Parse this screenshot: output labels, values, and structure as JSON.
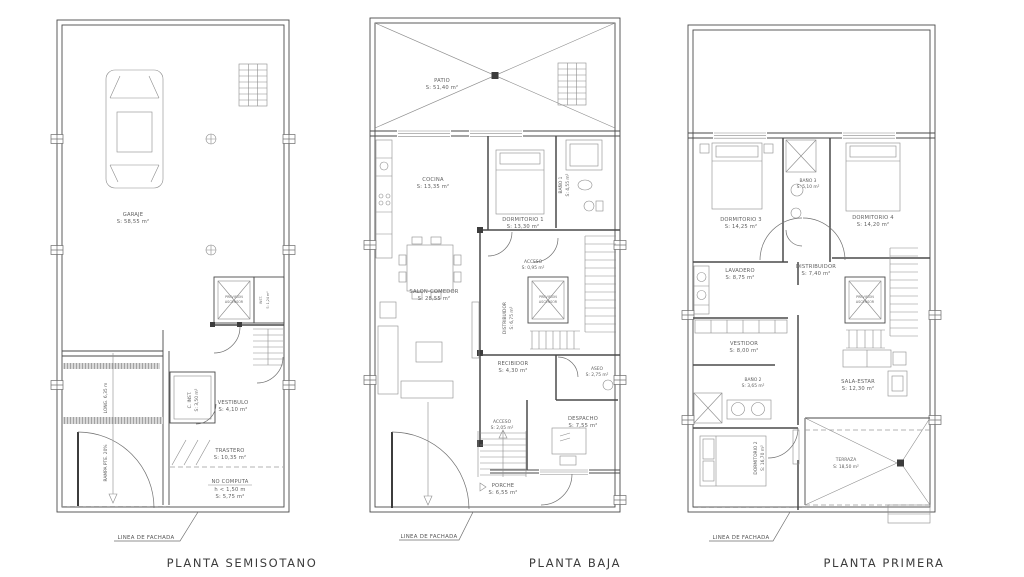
{
  "colors": {
    "background": "#ffffff",
    "line": "#4a4a4a",
    "text": "#5f5f5f",
    "title_text": "#3c3c3c"
  },
  "plans": [
    {
      "title": "PLANTA SEMISOTANO",
      "facade_label": "LINEA DE FACHADA",
      "rooms": {
        "garaje": {
          "name": "GARAJE",
          "area": "S: 58,55 m²"
        },
        "ascensor": {
          "line1": "PREVISION",
          "line2": "ASCENSOR"
        },
        "inst": {
          "name": "INST.",
          "area": "S: 1,24 m²"
        },
        "vestibulo": {
          "name": "VESTIBULO",
          "area": "S: 4,10 m²"
        },
        "c_inst": {
          "name": "C. INST.",
          "area": "S: 3,50 m²"
        },
        "trastero": {
          "name": "TRASTERO",
          "area": "S: 10,35 m²"
        },
        "no_computa": {
          "name": "NO COMPUTA",
          "height": "h < 1,50 m",
          "area": "S: 5,75 m²"
        },
        "ramp_length": "LONG. 6,35 m",
        "ramp_slope": "RAMPA PTE. 20%"
      }
    },
    {
      "title": "PLANTA BAJA",
      "facade_label": "LINEA DE FACHADA",
      "rooms": {
        "patio": {
          "name": "PATIO",
          "area": "S: 51,40 m²"
        },
        "cocina": {
          "name": "COCINA",
          "area": "S: 13,35 m²"
        },
        "dormitorio1": {
          "name": "DORMITORIO 1",
          "area": "S: 13,30 m²"
        },
        "bano1": {
          "name": "BAÑO 1",
          "area": "S: 4,55 m²"
        },
        "salon": {
          "name": "SALON-COMEDOR",
          "area": "S: 28,55 m²"
        },
        "acceso_sup": {
          "name": "ACCESO",
          "area": "S: 0,95 m²"
        },
        "distribuidor": {
          "name": "DISTRIBUIDOR",
          "area": "S: 6,75 m²"
        },
        "ascensor": {
          "line1": "PREVISION",
          "line2": "ASCENSOR"
        },
        "recibidor": {
          "name": "RECIBIDOR",
          "area": "S: 4,30 m²"
        },
        "aseo": {
          "name": "ASEO",
          "area": "S: 2,75 m²"
        },
        "despacho": {
          "name": "DESPACHO",
          "area": "S: 7,55 m²"
        },
        "acceso_inf": {
          "name": "ACCESO",
          "area": "S: 2,05 m²"
        },
        "porche": {
          "name": "PORCHE",
          "area": "S: 6,55 m²"
        }
      }
    },
    {
      "title": "PLANTA PRIMERA",
      "facade_label": "LINEA DE FACHADA",
      "rooms": {
        "dormitorio3": {
          "name": "DORMITORIO 3",
          "area": "S: 14,25 m²"
        },
        "bano3": {
          "name": "BAÑO 3",
          "area": "S: 5,10 m²"
        },
        "dormitorio4": {
          "name": "DORMITORIO 4",
          "area": "S: 14,20 m²"
        },
        "lavadero": {
          "name": "LAVADERO",
          "area": "S: 8,75 m²"
        },
        "distribuidor": {
          "name": "DISTRIBUIDOR",
          "area": "S: 7,40 m²"
        },
        "ascensor": {
          "line1": "PREVISION",
          "line2": "ASCENSOR"
        },
        "vestidor": {
          "name": "VESTIDOR",
          "area": "S: 8,00 m²"
        },
        "bano2": {
          "name": "BAÑO 2",
          "area": "S: 3,65 m²"
        },
        "sala_estar": {
          "name": "SALA-ESTAR",
          "area": "S: 12,30 m²"
        },
        "dormitorio2": {
          "name": "DORMITORIO 2",
          "area": "S: 16,70 m²"
        },
        "terraza": {
          "name": "TERRAZA",
          "area": "S: 18,50 m²"
        }
      }
    }
  ]
}
